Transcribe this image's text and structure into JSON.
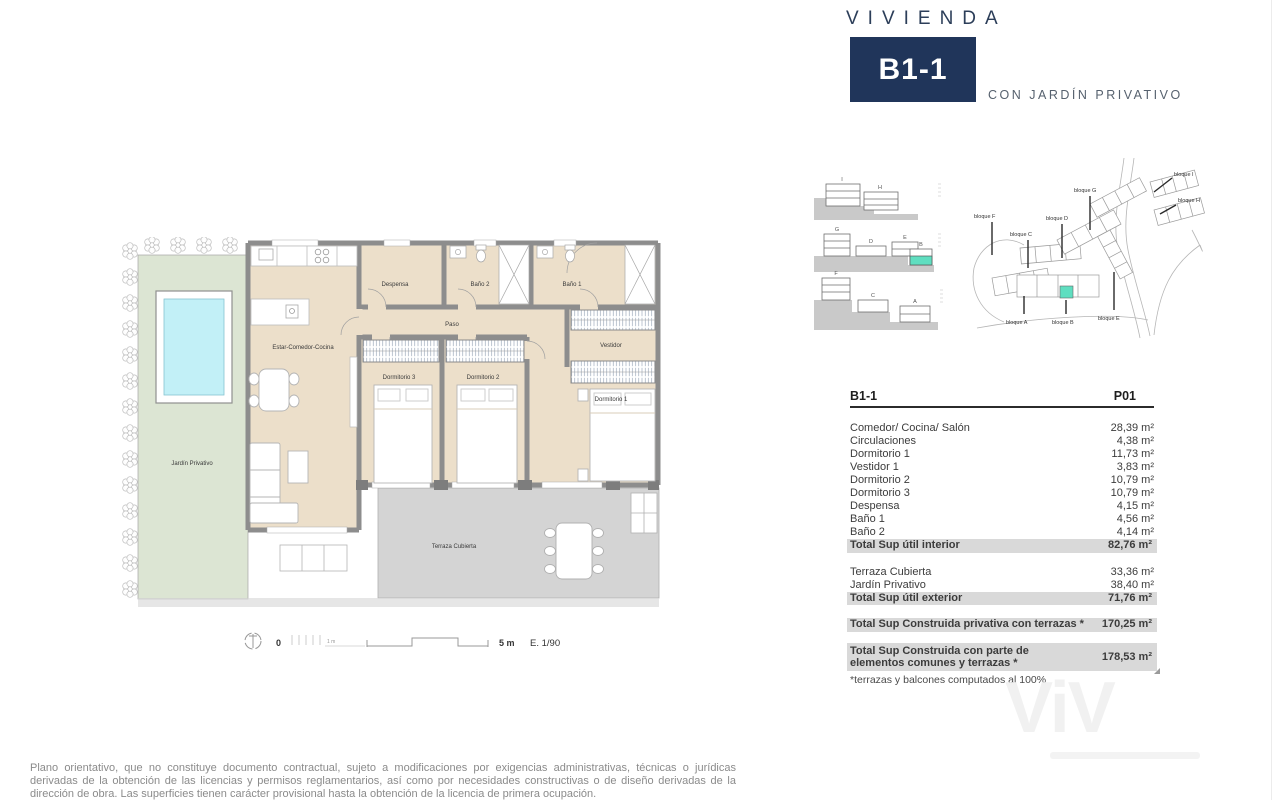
{
  "header": {
    "kicker": "VIVIENDA",
    "unit": "B1-1",
    "subtitle": "CON JARDÍN PRIVATIVO"
  },
  "plan": {
    "rooms": {
      "living": "Estar-Comedor-Cocina",
      "despensa": "Despensa",
      "bano2": "Baño 2",
      "bano1": "Baño 1",
      "paso": "Paso",
      "dorm3": "Dormitorio 3",
      "dorm2": "Dormitorio 2",
      "dorm1": "Dormitorio 1",
      "vestidor": "Vestidor",
      "jardin": "Jardín Privativo",
      "terraza": "Terraza Cubierta"
    },
    "scale": {
      "zero": "0",
      "one_m": "1 m",
      "five_m": "5 m",
      "ratio": "E. 1/90"
    },
    "colors": {
      "garden": "#dce5d3",
      "pool": "#c2f0f7",
      "floor": "#ecdfca",
      "wall": "#8d8d8d",
      "terrace": "#d4d4d4"
    }
  },
  "sections": {
    "row1": [
      "I",
      "H"
    ],
    "row2": [
      "G",
      "D",
      "E",
      "B"
    ],
    "row3": [
      "F",
      "C",
      "A"
    ],
    "highlight": "#5fdec0"
  },
  "sitemap": {
    "labels": {
      "f": "bloque F",
      "c": "bloque C",
      "d": "bloque D",
      "g": "bloque G",
      "i": "bloque I",
      "h": "bloque H",
      "a": "bloque A",
      "b": "bloque B",
      "e": "bloque E"
    }
  },
  "table": {
    "unit": "B1-1",
    "floor": "P01",
    "rows": [
      {
        "label": "Comedor/ Cocina/ Salón",
        "value": "28,39 m²"
      },
      {
        "label": "Circulaciones",
        "value": "4,38 m²"
      },
      {
        "label": "Dormitorio 1",
        "value": "11,73 m²"
      },
      {
        "label": "Vestidor 1",
        "value": "3,83 m²"
      },
      {
        "label": "Dormitorio 2",
        "value": "10,79 m²"
      },
      {
        "label": "Dormitorio 3",
        "value": "10,79 m²"
      },
      {
        "label": "Despensa",
        "value": "4,15 m²"
      },
      {
        "label": "Baño 1",
        "value": "4,56 m²"
      },
      {
        "label": "Baño 2",
        "value": "4,14 m²"
      }
    ],
    "total_interior": {
      "label": "Total Sup útil interior",
      "value": "82,76 m²"
    },
    "exterior_rows": [
      {
        "label": "Terraza Cubierta",
        "value": "33,36 m²"
      },
      {
        "label": "Jardín Privativo",
        "value": "38,40 m²"
      }
    ],
    "total_exterior": {
      "label": "Total Sup útil exterior",
      "value": "71,76 m²"
    },
    "total_privativa": {
      "label": "Total Sup Construida privativa con terrazas *",
      "value": "170,25 m²"
    },
    "total_comunes": {
      "label": "Total Sup Construida con parte de elementos comunes y terrazas *",
      "value": "178,53 m²"
    },
    "footnote": "*terrazas y balcones computados al 100%"
  },
  "watermark": "ViV",
  "disclaimer": "Plano orientativo, que no constituye documento contractual, sujeto a modificaciones por exigencias administrativas, técnicas o jurídicas derivadas de la obtención de las licencias y permisos reglamentarios, así como por necesidades constructivas o de diseño derivadas de la dirección de obra. Las superficies tienen carácter provisional hasta la obtención de la licencia de primera ocupación."
}
